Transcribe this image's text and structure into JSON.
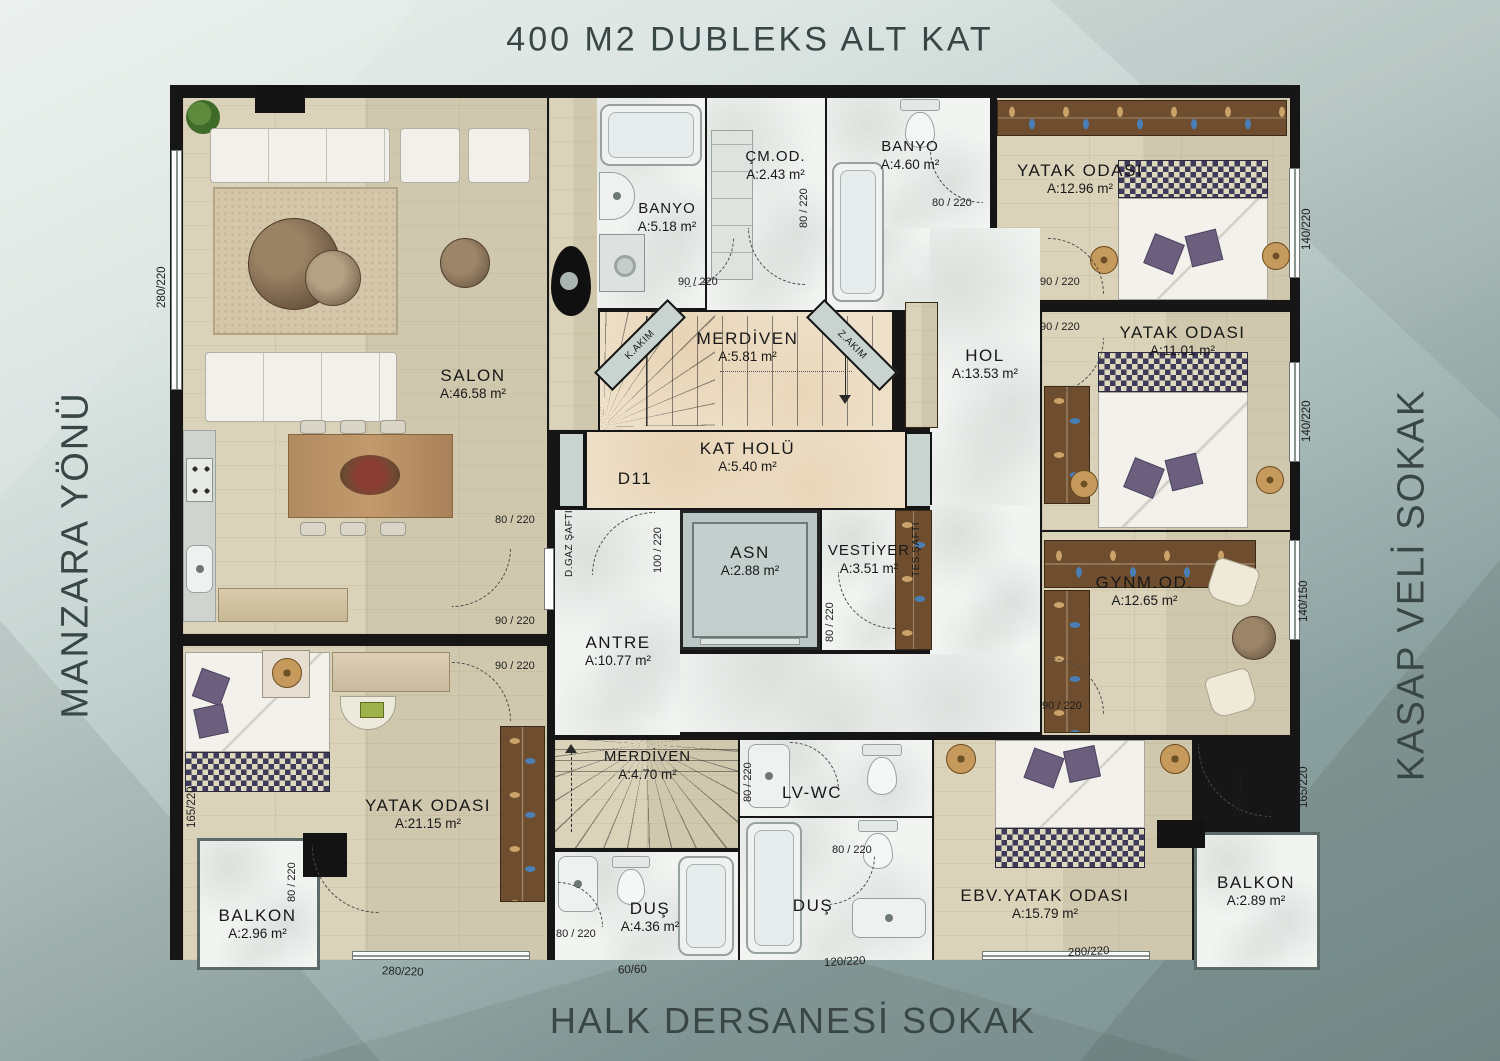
{
  "title": "400 M2  DUBLEKS  ALT  KAT",
  "unit": "D11",
  "streets": {
    "left": "MANZARA YÖNÜ",
    "right": "KASAP VELİ SOKAK",
    "bottom": "HALK DERSANESİ SOKAK"
  },
  "rooms": {
    "salon": {
      "name": "SALON",
      "area": "A:46.58 m²"
    },
    "banyo1": {
      "name": "BANYO",
      "area": "A:5.18 m²"
    },
    "cmod": {
      "name": "ÇM.OD.",
      "area": "A:2.43 m²"
    },
    "banyo2": {
      "name": "BANYO",
      "area": "A:4.60 m²"
    },
    "yatak1": {
      "name": "YATAK ODASI",
      "area": "A:12.96 m²"
    },
    "merdiven1": {
      "name": "MERDİVEN",
      "area": "A:5.81 m²"
    },
    "hol": {
      "name": "HOL",
      "area": "A:13.53 m²"
    },
    "yatak2": {
      "name": "YATAK ODASI",
      "area": "A:11.01 m²"
    },
    "katholu": {
      "name": "KAT HOLÜ",
      "area": "A:5.40 m²"
    },
    "asn": {
      "name": "ASN",
      "area": "A:2.88 m²"
    },
    "vestiyer": {
      "name": "VESTİYER",
      "area": "A:3.51 m²"
    },
    "gynmod": {
      "name": "GYNM.OD.",
      "area": "A:12.65 m²"
    },
    "antre": {
      "name": "ANTRE",
      "area": "A:10.77 m²"
    },
    "yatak3": {
      "name": "YATAK ODASI",
      "area": "A:21.15 m²"
    },
    "merdiven2": {
      "name": "MERDİVEN",
      "area": "A:4.70 m²"
    },
    "lvwc": {
      "name": "LV-WC"
    },
    "balkon1": {
      "name": "BALKON",
      "area": "A:2.96 m²"
    },
    "dus1": {
      "name": "DUŞ",
      "area": "A:4.36 m²"
    },
    "dus2": {
      "name": "DUŞ"
    },
    "ebvyatak": {
      "name": "EBV.YATAK ODASI",
      "area": "A:15.79 m²"
    },
    "balkon2": {
      "name": "BALKON",
      "area": "A:2.89 m²"
    }
  },
  "shafts": {
    "kakim": "K.AKIM",
    "zakim": "Z.AKIM",
    "dgaz": "D.GAZ ŞAFTI",
    "tes": "TES.ŞAFTI"
  },
  "doors": {
    "d1": "90 / 220",
    "d2": "80 / 220",
    "d3": "80 / 220",
    "d4": "90 / 220",
    "d5": "90 / 220",
    "d6": "100 / 220",
    "d7": "80 / 220",
    "d8": "90 / 220",
    "d9": "90 / 220",
    "d10": "80 / 220",
    "d11": "80 / 220",
    "d12": "90 / 220",
    "d13": "80 / 220",
    "d14": "80 / 220",
    "d15": "80 / 220",
    "d16": "80 / 220"
  },
  "dimensions": {
    "left_top": "280/220",
    "left_bottom": "165/220",
    "right_top": "140/220",
    "right_mid": "140/220",
    "right_low": "140/150",
    "right_bottom": "165/220",
    "bottom_left": "280/220",
    "bottom_small": "60/60",
    "bottom_mid": "120/220",
    "bottom_right": "280/220"
  },
  "colors": {
    "wall": "#161616",
    "wood_floor": "#d7ceb3",
    "marble_floor": "#f2f4f2",
    "stair_floor": "#eee0c9",
    "shaft_box": "#c9d3d0",
    "pillow_purple": "#6c5f7e",
    "street_text": "#394646"
  }
}
